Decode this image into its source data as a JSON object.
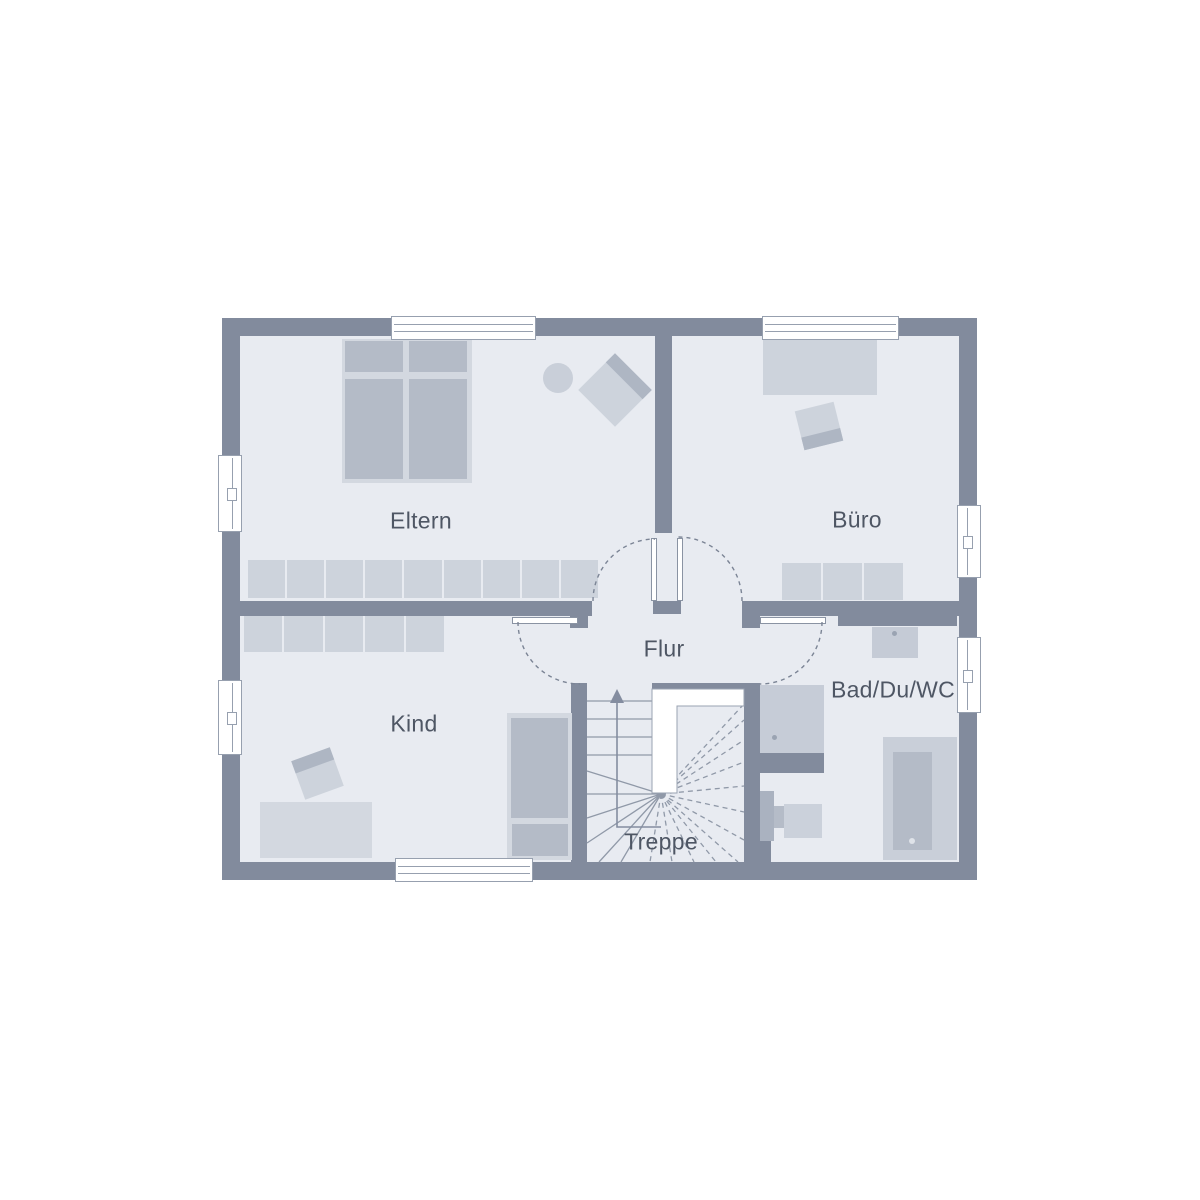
{
  "floorplan": {
    "rooms": [
      {
        "id": "eltern",
        "label": "Eltern"
      },
      {
        "id": "buero",
        "label": "Büro"
      },
      {
        "id": "kind",
        "label": "Kind"
      },
      {
        "id": "flur",
        "label": "Flur"
      },
      {
        "id": "bad",
        "label": "Bad/Du/WC"
      },
      {
        "id": "treppe",
        "label": "Treppe"
      }
    ]
  },
  "colors": {
    "wall": "#828b9d",
    "floor": "#e8ebf1",
    "furn": "#cdd3dc",
    "furnDark": "#b4bbc7",
    "furnLight": "#d3d8e0",
    "fixture": "#c9cfd9",
    "line": "#97a0af",
    "dash": "#7b8495",
    "stair": "#9099a8",
    "text": "#4e5664",
    "dot": "#9aa3b2",
    "white": "#ffffff"
  }
}
